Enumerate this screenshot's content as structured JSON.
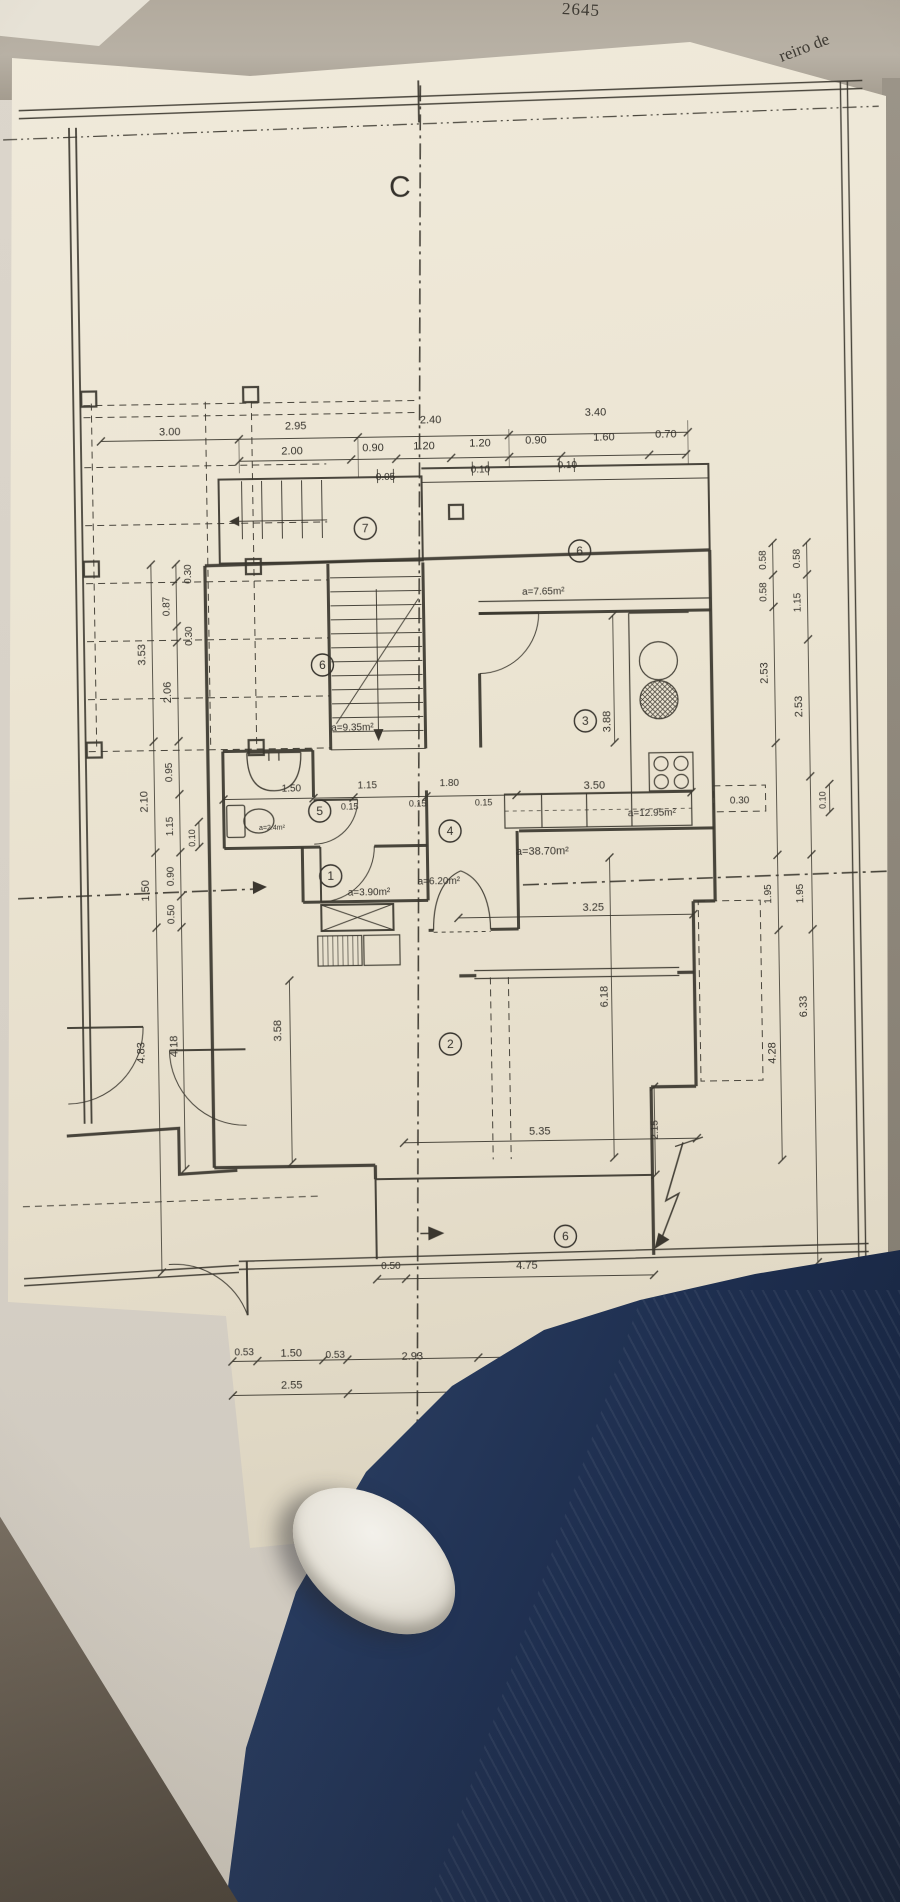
{
  "photo": {
    "back_sheet_number": "2645",
    "back_sheet_text": "reiro de",
    "colors": {
      "paper": "#ece5d3",
      "behind_paper": "#b2aa9d",
      "floor": "#d6d0c6",
      "jeans": "#2b3f63",
      "shoe": "#e6e2d8",
      "ink": "#3b372f"
    }
  },
  "plan": {
    "section_labels": {
      "top": "C",
      "bottom": "D"
    },
    "rooms": [
      {
        "n": "7",
        "x": 368,
        "y": 527
      },
      {
        "n": "6",
        "x": 582,
        "y": 553
      },
      {
        "n": "6",
        "x": 323,
        "y": 663
      },
      {
        "n": "3",
        "x": 585,
        "y": 723
      },
      {
        "n": "5",
        "x": 318,
        "y": 809
      },
      {
        "n": "4",
        "x": 448,
        "y": 831
      },
      {
        "n": "1",
        "x": 328,
        "y": 874
      },
      {
        "n": "2",
        "x": 445,
        "y": 1044
      },
      {
        "n": "6",
        "x": 557,
        "y": 1238
      }
    ],
    "labels": [
      {
        "t": "C",
        "x": 408,
        "y": 196,
        "s": 30,
        "n": "section-label-c"
      },
      {
        "t": "D",
        "x": 385,
        "y": 1492,
        "s": 30,
        "n": "section-label-d"
      },
      {
        "t": "3.00",
        "x": 174,
        "y": 431
      },
      {
        "t": "2.95",
        "x": 300,
        "y": 427
      },
      {
        "t": "2.40",
        "x": 435,
        "y": 423
      },
      {
        "t": "3.40",
        "x": 600,
        "y": 418
      },
      {
        "t": "2.00",
        "x": 296,
        "y": 452
      },
      {
        "t": "0.90",
        "x": 377,
        "y": 450
      },
      {
        "t": "1.20",
        "x": 428,
        "y": 449
      },
      {
        "t": "1.20",
        "x": 484,
        "y": 447
      },
      {
        "t": "0.90",
        "x": 540,
        "y": 445
      },
      {
        "t": "1.60",
        "x": 608,
        "y": 443
      },
      {
        "t": "0.70",
        "x": 670,
        "y": 441
      },
      {
        "t": "0.05",
        "x": 389,
        "y": 479,
        "s": 10
      },
      {
        "t": "0.10",
        "x": 484,
        "y": 473,
        "s": 10
      },
      {
        "t": "0.10",
        "x": 571,
        "y": 470,
        "s": 10
      },
      {
        "t": "3.53",
        "x": 146,
        "y": 650,
        "r": -90
      },
      {
        "t": "0.30",
        "x": 193,
        "y": 570,
        "r": -90,
        "s": 10
      },
      {
        "t": "0.87",
        "x": 171,
        "y": 602,
        "r": -90,
        "s": 10
      },
      {
        "t": "0.30",
        "x": 193,
        "y": 632,
        "r": -90,
        "s": 10
      },
      {
        "t": "2.06",
        "x": 171,
        "y": 688,
        "r": -90
      },
      {
        "t": "0.95",
        "x": 171,
        "y": 768,
        "r": -90,
        "s": 10
      },
      {
        "t": "2.10",
        "x": 146,
        "y": 797,
        "r": -90
      },
      {
        "t": "1.15",
        "x": 171,
        "y": 822,
        "r": -90,
        "s": 10
      },
      {
        "t": "0.10",
        "x": 193,
        "y": 834,
        "r": -90,
        "s": 9
      },
      {
        "t": "1.50",
        "x": 146,
        "y": 886,
        "r": -90
      },
      {
        "t": "0.90",
        "x": 171,
        "y": 872,
        "r": -90,
        "s": 10
      },
      {
        "t": "0.50",
        "x": 171,
        "y": 910,
        "r": -90,
        "s": 10
      },
      {
        "t": "4.83",
        "x": 139,
        "y": 1048,
        "r": -90
      },
      {
        "t": "4.18",
        "x": 172,
        "y": 1042,
        "r": -90
      },
      {
        "t": "0.58",
        "x": 768,
        "y": 565,
        "r": -90,
        "s": 10
      },
      {
        "t": "0.58",
        "x": 768,
        "y": 597,
        "r": -90,
        "s": 10
      },
      {
        "t": "2.53",
        "x": 768,
        "y": 678,
        "r": -90
      },
      {
        "t": "1.95",
        "x": 768,
        "y": 899,
        "r": -90,
        "s": 10
      },
      {
        "t": "4.28",
        "x": 770,
        "y": 1058,
        "r": -90
      },
      {
        "t": "0.58",
        "x": 802,
        "y": 564,
        "r": -90,
        "s": 10
      },
      {
        "t": "1.15",
        "x": 802,
        "y": 608,
        "r": -90,
        "s": 10
      },
      {
        "t": "2.53",
        "x": 802,
        "y": 712,
        "r": -90
      },
      {
        "t": "1.95",
        "x": 800,
        "y": 899,
        "r": -90,
        "s": 10
      },
      {
        "t": "6.33",
        "x": 802,
        "y": 1012,
        "r": -90
      },
      {
        "t": "0.10",
        "x": 824,
        "y": 806,
        "r": -90,
        "s": 9
      },
      {
        "t": "0.30",
        "x": 738,
        "y": 808,
        "s": 10
      },
      {
        "t": "1.50",
        "x": 290,
        "y": 789,
        "s": 10
      },
      {
        "t": "1.15",
        "x": 366,
        "y": 787,
        "s": 10
      },
      {
        "t": "0.15",
        "x": 348,
        "y": 808,
        "s": 9
      },
      {
        "t": "0.15",
        "x": 416,
        "y": 806,
        "s": 9
      },
      {
        "t": "1.80",
        "x": 448,
        "y": 786,
        "s": 10
      },
      {
        "t": "0.15",
        "x": 482,
        "y": 806,
        "s": 9
      },
      {
        "t": "3.50",
        "x": 593,
        "y": 791
      },
      {
        "t": "3.88",
        "x": 610,
        "y": 724,
        "r": -90
      },
      {
        "t": "3.25",
        "x": 590,
        "y": 913
      },
      {
        "t": "5.35",
        "x": 533,
        "y": 1136
      },
      {
        "t": "3.58",
        "x": 276,
        "y": 1028,
        "r": -90
      },
      {
        "t": "6.18",
        "x": 603,
        "y": 999,
        "r": -90
      },
      {
        "t": "2.15",
        "x": 651,
        "y": 1133,
        "r": -90,
        "s": 10
      },
      {
        "t": "0.50",
        "x": 382,
        "y": 1268,
        "s": 10
      },
      {
        "t": "4.75",
        "x": 518,
        "y": 1270
      },
      {
        "t": "0.53",
        "x": 234,
        "y": 1352,
        "s": 10
      },
      {
        "t": "1.50",
        "x": 281,
        "y": 1354
      },
      {
        "t": "0.53",
        "x": 325,
        "y": 1356,
        "s": 10
      },
      {
        "t": "2.93",
        "x": 402,
        "y": 1359
      },
      {
        "t": "2.50",
        "x": 528,
        "y": 1363
      },
      {
        "t": "0.53",
        "x": 597,
        "y": 1366,
        "s": 10
      },
      {
        "t": "2.55",
        "x": 281,
        "y": 1386
      },
      {
        "t": "5.95",
        "x": 470,
        "y": 1394
      },
      {
        "t": "a=9.35m²",
        "x": 352,
        "y": 729,
        "s": 10,
        "n": "area-label"
      },
      {
        "t": "a=7.65m²",
        "x": 545,
        "y": 596,
        "s": 10,
        "n": "area-label"
      },
      {
        "t": "a=12.95m²",
        "x": 650,
        "y": 819,
        "s": 10,
        "n": "area-label"
      },
      {
        "t": "a=38.70m²",
        "x": 540,
        "y": 856,
        "s": 11,
        "n": "area-label"
      },
      {
        "t": "a=6.20m²",
        "x": 436,
        "y": 884,
        "s": 10,
        "n": "area-label"
      },
      {
        "t": "a=3.90m²",
        "x": 366,
        "y": 894,
        "s": 10,
        "n": "area-label"
      },
      {
        "t": "a=2.4m²",
        "x": 270,
        "y": 827,
        "s": 7,
        "n": "area-label"
      }
    ],
    "dim_chains": [
      {
        "d": "h",
        "p": 436,
        "a": 105,
        "b": 692,
        "t": [
          105,
          243,
          362,
          513,
          692
        ]
      },
      {
        "d": "h",
        "p": 458,
        "a": 243,
        "b": 690,
        "t": [
          243,
          355,
          400,
          455,
          513,
          565,
          653,
          690
        ]
      },
      {
        "d": "h",
        "p": 796,
        "a": 222,
        "b": 690,
        "t": [
          222,
          312,
          352,
          425,
          515,
          690
        ]
      },
      {
        "d": "h",
        "p": 918,
        "a": 455,
        "b": 690,
        "t": [
          455,
          690
        ]
      },
      {
        "d": "h",
        "p": 1142,
        "a": 397,
        "b": 690,
        "t": [
          397,
          690
        ]
      },
      {
        "d": "h",
        "p": 1278,
        "a": 368,
        "b": 645,
        "t": [
          368,
          397,
          645
        ]
      },
      {
        "d": "h",
        "p": 1358,
        "a": 222,
        "b": 608,
        "t": [
          222,
          247,
          313,
          337,
          468,
          583,
          608
        ]
      },
      {
        "d": "h",
        "p": 1392,
        "a": 222,
        "b": 608,
        "t": [
          222,
          337,
          608
        ]
      },
      {
        "d": "v",
        "p": 153,
        "a": 560,
        "b": 1268,
        "t": [
          560,
          737,
          848,
          923,
          1268
        ]
      },
      {
        "d": "v",
        "p": 178,
        "a": 560,
        "b": 1165,
        "t": [
          560,
          577,
          622,
          638,
          737,
          790,
          848,
          892,
          923,
          1165
        ]
      },
      {
        "d": "v",
        "p": 197,
        "a": 818,
        "b": 843,
        "t": [
          818,
          843
        ]
      },
      {
        "d": "v",
        "p": 775,
        "a": 548,
        "b": 1165,
        "t": [
          548,
          580,
          612,
          748,
          860,
          935,
          1165
        ]
      },
      {
        "d": "v",
        "p": 809,
        "a": 548,
        "b": 1268,
        "t": [
          548,
          580,
          645,
          782,
          860,
          935,
          1268
        ]
      },
      {
        "d": "v",
        "p": 828,
        "a": 790,
        "b": 818,
        "t": [
          790,
          818
        ]
      },
      {
        "d": "v",
        "p": 614,
        "a": 618,
        "b": 745,
        "t": [
          618,
          745
        ]
      },
      {
        "d": "v",
        "p": 607,
        "a": 860,
        "b": 1160,
        "t": [
          860,
          1160
        ]
      },
      {
        "d": "v",
        "p": 648,
        "a": 1090,
        "b": 1178,
        "t": [
          1090,
          1178
        ]
      },
      {
        "d": "v",
        "p": 285,
        "a": 978,
        "b": 1160,
        "t": [
          978,
          1160
        ]
      }
    ]
  }
}
